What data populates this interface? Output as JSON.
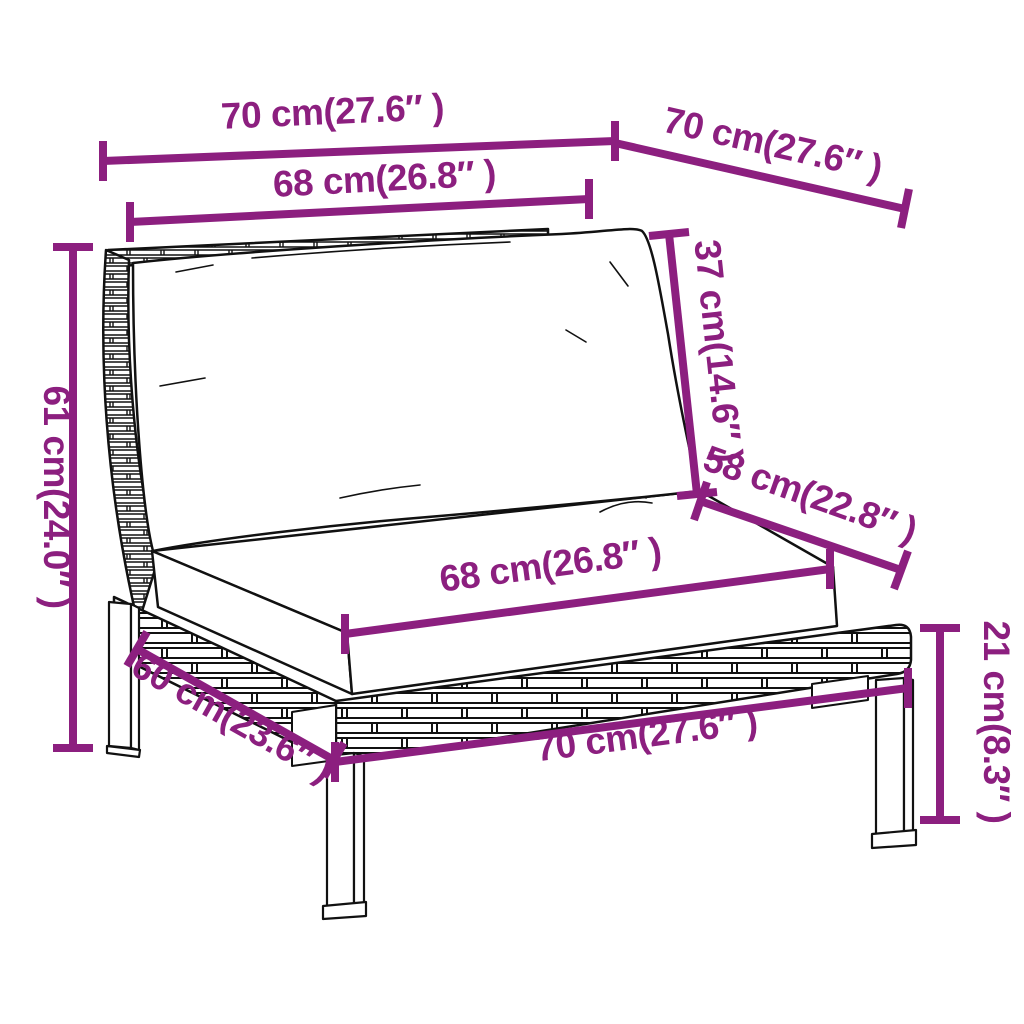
{
  "diagram": {
    "kind": "product-dimension-drawing",
    "colors": {
      "dimension_accent": "#8C1F7F",
      "outline": "#111111",
      "background": "#ffffff",
      "cushion_fill": "#ffffff"
    }
  },
  "dimensions": {
    "top_width": {
      "label": "70 cm(27.6″ )"
    },
    "top_depth": {
      "label": "70 cm(27.6″ )"
    },
    "back_cushion_width": {
      "label": "68 cm(26.8″ )"
    },
    "back_cushion_height": {
      "label": "37 cm(14.6″ )"
    },
    "seat_depth": {
      "label": "58 cm(22.8″ )"
    },
    "seat_cushion_width": {
      "label": "68 cm(26.8″ )"
    },
    "overall_height": {
      "label": "61 cm(24.0″ )"
    },
    "base_side_width": {
      "label": "60 cm(23.6″ )"
    },
    "base_front_width": {
      "label": "70 cm(27.6″ )"
    },
    "leg_height": {
      "label": "21 cm(8.3″ )"
    }
  }
}
